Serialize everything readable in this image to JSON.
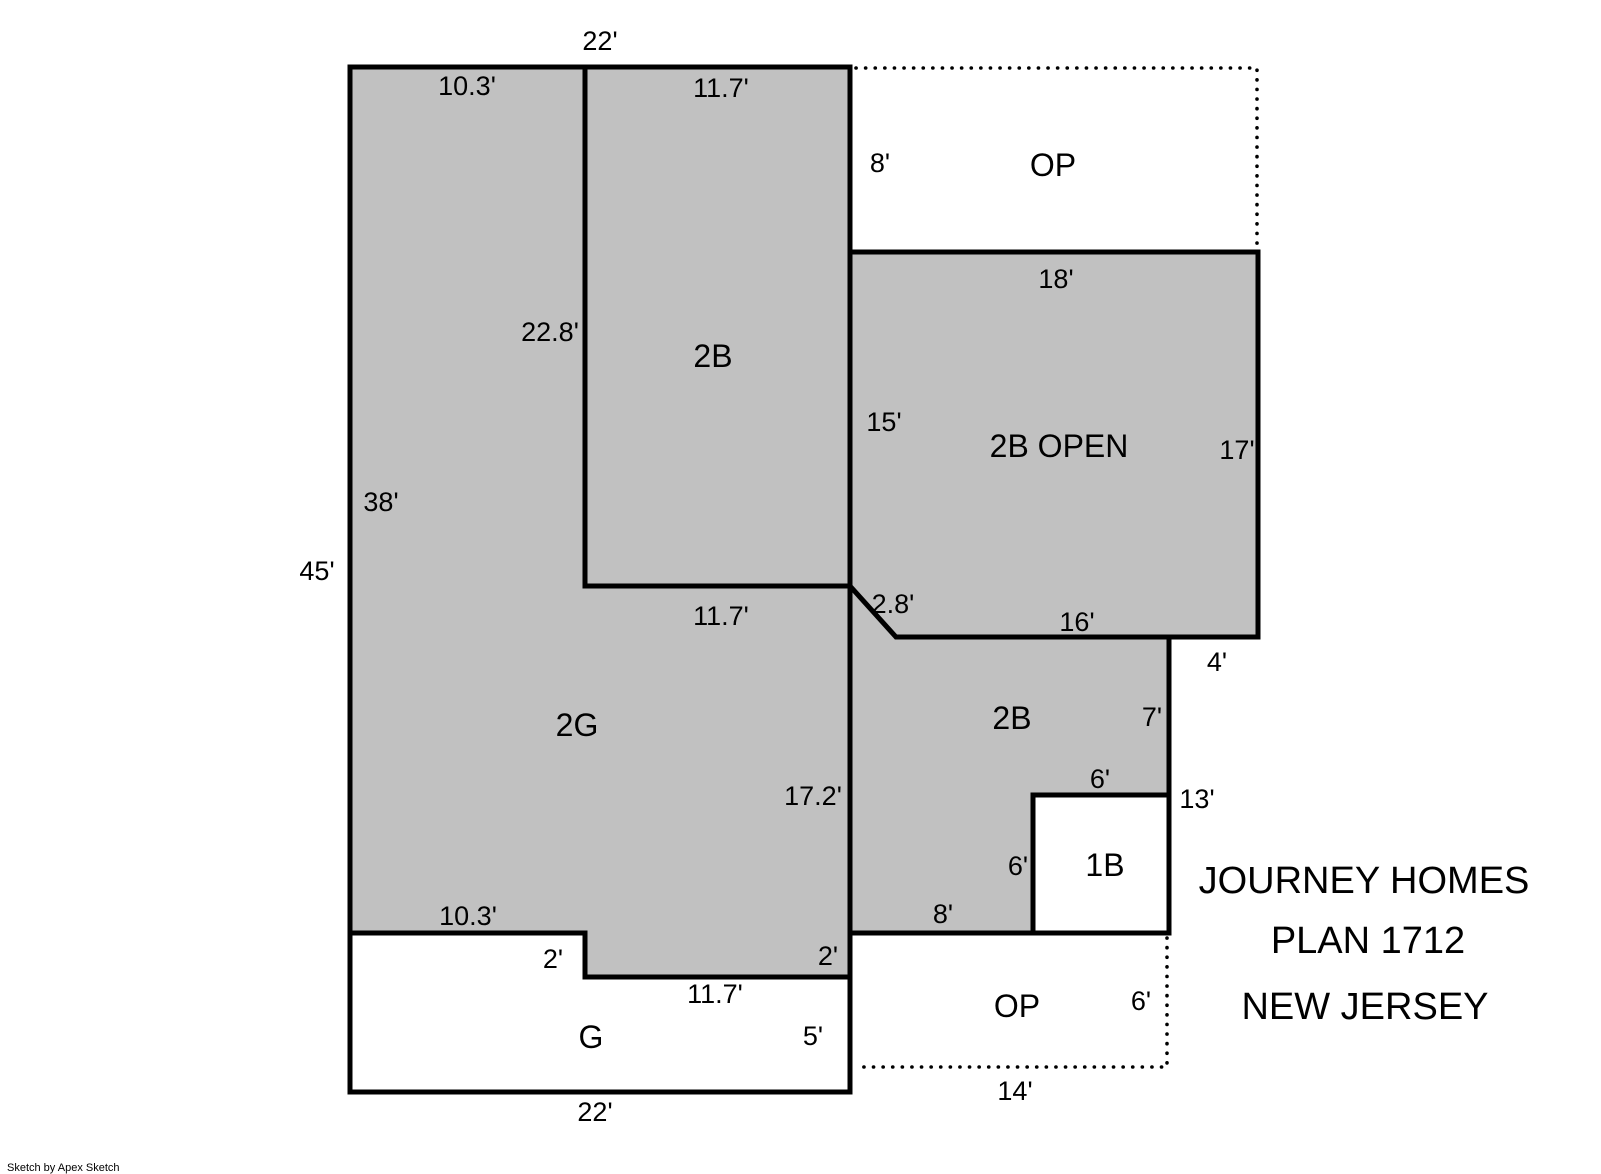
{
  "title_block": {
    "line1": "JOURNEY HOMES",
    "line2": "PLAN 1712",
    "line3": "NEW JERSEY"
  },
  "watermark": "Sketch by Apex Sketch",
  "colors": {
    "area_fill": "#c1c1c1",
    "wall": "#000000",
    "text": "#000000",
    "background": "#ffffff"
  },
  "rooms": {
    "bedroom_upper": "2B",
    "open_area": "2B OPEN",
    "garage_2g": "2G",
    "bedroom_lower": "2B",
    "bath_1b": "1B",
    "garage_g": "G",
    "porch_upper": "OP",
    "porch_lower": "OP"
  },
  "dimensions": {
    "top_width": "22'",
    "top_left_segment": "10.3'",
    "top_right_segment": "11.7'",
    "porch_upper_left_height": "8'",
    "open_area_top_width": "18'",
    "bedroom_upper_left_height": "22.8'",
    "bedroom_upper_right_height": "15'",
    "open_area_right_height": "17'",
    "left_upper_height": "38'",
    "left_total_height": "45'",
    "bedroom_upper_bottom_width": "11.7'",
    "diagonal_wall": "2.8'",
    "open_area_bottom_width": "16'",
    "right_notch_width": "4'",
    "right_mid_height": "7'",
    "bath_top_width": "6'",
    "right_lower_height": "13'",
    "bath_left_height": "6'",
    "garage_2g_right_height": "17.2'",
    "bedroom_lower_bottom_width": "8'",
    "garage_top_left_width": "10.3'",
    "garage_step_left": "2'",
    "garage_step_right": "2'",
    "garage_top_right_width": "11.7'",
    "garage_right_height": "5'",
    "garage_bottom_width": "22'",
    "porch_lower_right_height": "6'",
    "porch_lower_bottom_width": "14'"
  }
}
